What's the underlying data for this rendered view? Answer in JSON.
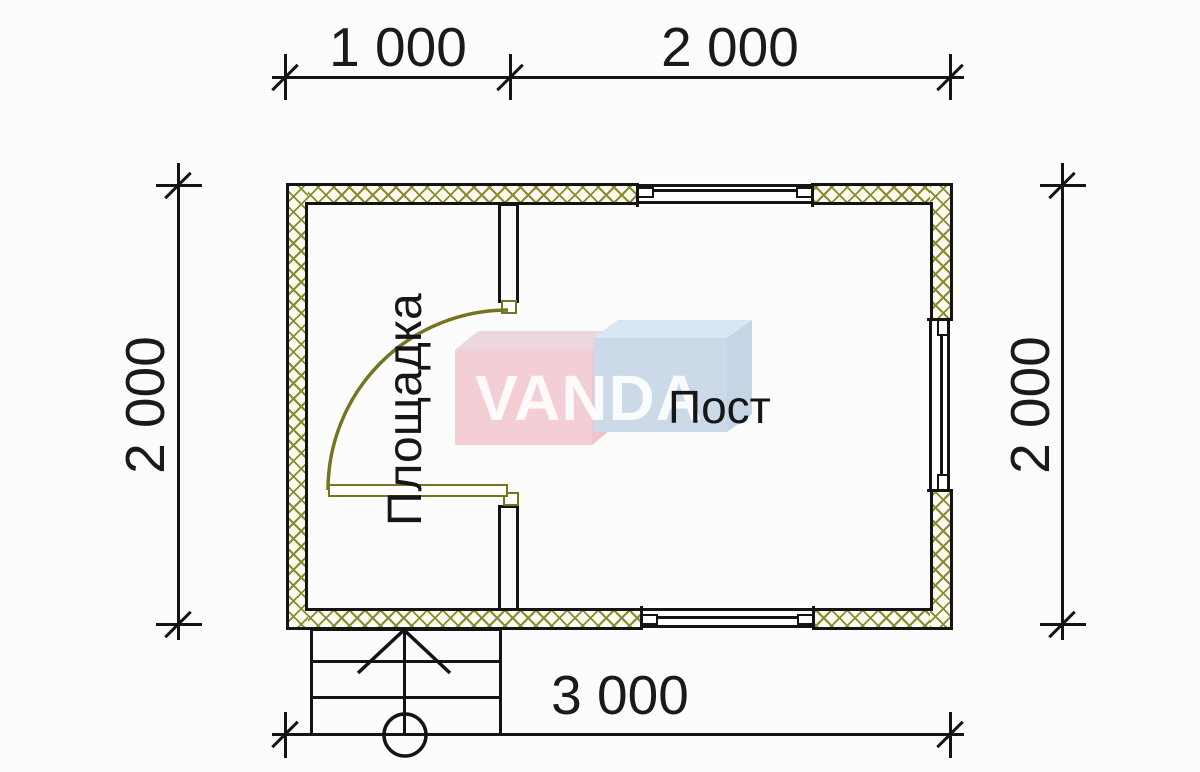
{
  "drawing": {
    "dimensions": {
      "top_left": "1 000",
      "top_right": "2 000",
      "side_left": "2 000",
      "side_right": "2 000",
      "bottom": "3 000"
    },
    "rooms": {
      "porch": "Площадка",
      "post": "Пост"
    },
    "watermark": {
      "text": "VANDA",
      "pink_box_color": "#f4ced5",
      "blue_box_color": "#ccd9e8"
    },
    "colors": {
      "wall_hatch_line": "#8a8a33",
      "wall_hatch_bg": "#fbfbee",
      "door": "#75751f",
      "ink": "#141414"
    }
  }
}
